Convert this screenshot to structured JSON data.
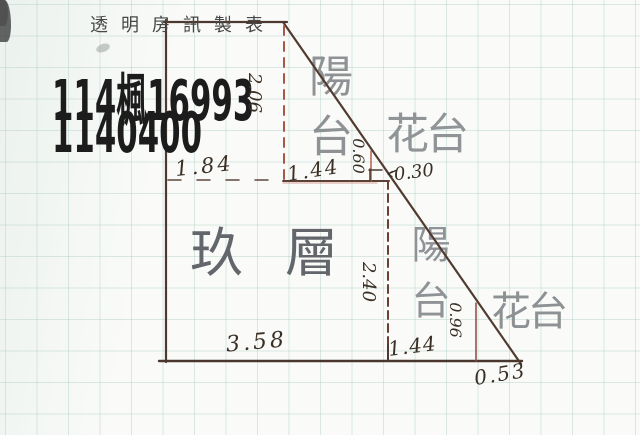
{
  "header": {
    "title": "透明房訊製表"
  },
  "document_numbers": {
    "line1": "114楓16993",
    "line2": "1140400"
  },
  "floor_plan": {
    "labels": {
      "balcony_upper": "陽台",
      "flower_bed_upper": "花台",
      "main_room": "玖層",
      "balcony_lower": "陽台",
      "flower_bed_lower": "花台"
    },
    "dimensions": {
      "left_edge_height": "2.06",
      "room_top_width": "1.84",
      "balcony_upper_width": "1.44",
      "flower_upper_height": "0.60",
      "flower_upper_width": "0.30",
      "room_height": "2.40",
      "room_bottom_width": "3.58",
      "balcony_lower_width": "1.44",
      "balcony_lower_height": "0.96",
      "flower_lower_width": "0.53"
    }
  },
  "colors": {
    "ink_line": "#4e3930",
    "red_dashed_line": "#a85848",
    "handwriting_ink": "#3a2f24",
    "room_label_gray": "#8d9194",
    "grid_line": "#cfe0da",
    "paper": "#fafbf9"
  }
}
